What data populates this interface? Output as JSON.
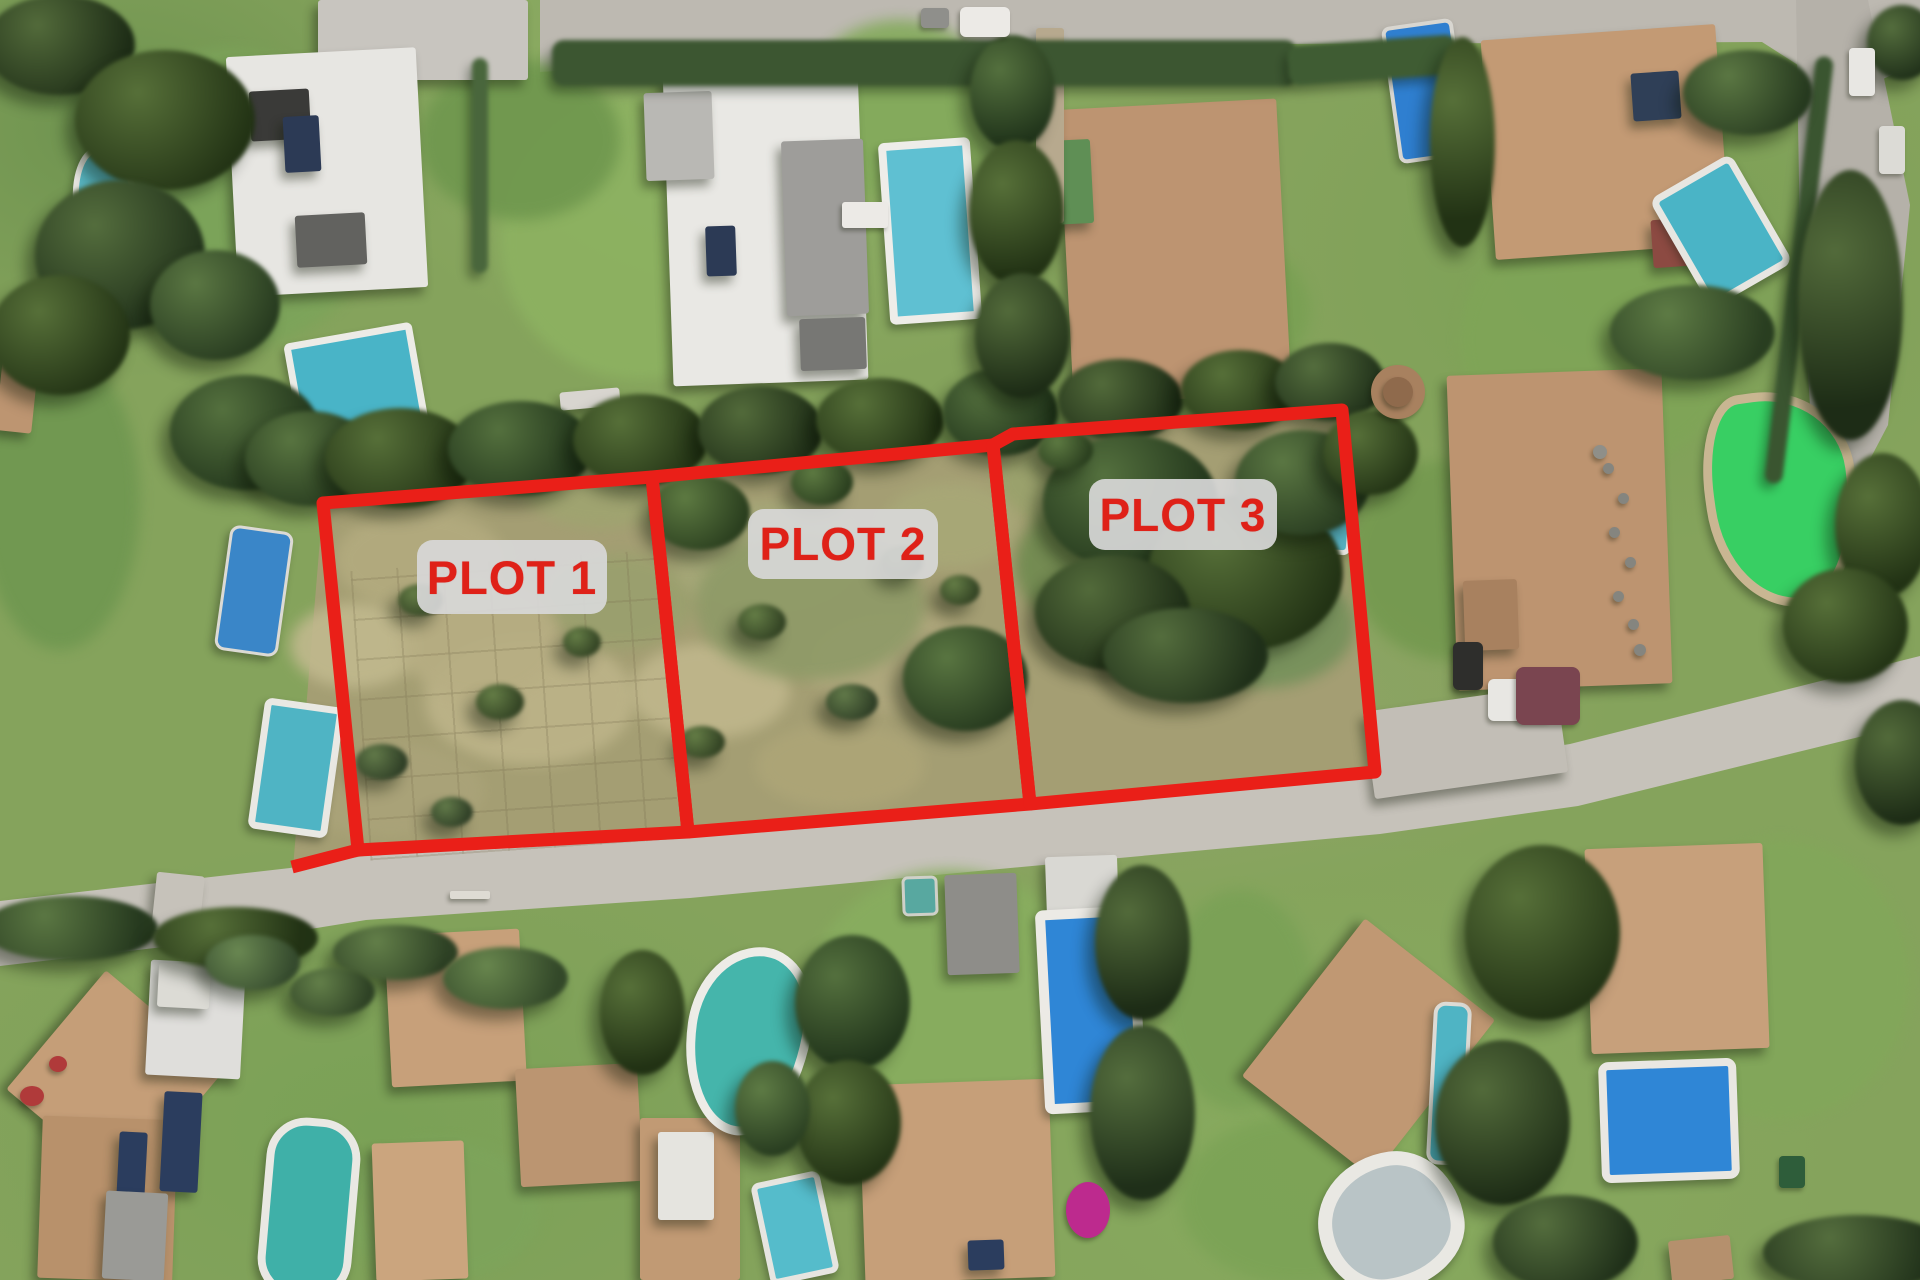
{
  "image": {
    "kind": "aerial-satellite-photo",
    "description": "Aerial view of a residential villa neighborhood with three vacant land parcels outlined in red"
  },
  "annotation": {
    "stroke_color": "#ea1f18",
    "stroke_width": 13,
    "label_bg": "rgba(216,216,216,0.92)",
    "label_text_color": "#df2118",
    "plots": [
      {
        "name": "plot-1",
        "label": "PLOT 1",
        "polygon": "323,503 652,477 688,832 358,850",
        "label_box": {
          "x": 417,
          "y": 540,
          "w": 190,
          "h": 74,
          "f": 47
        }
      },
      {
        "name": "plot-2",
        "label": "PLOT 2",
        "polygon": "652,477 993,445 1030,804 688,832",
        "label_box": {
          "x": 748,
          "y": 509,
          "w": 190,
          "h": 70,
          "f": 46
        }
      },
      {
        "name": "plot-3",
        "label": "PLOT 3",
        "polygon": "993,445 1013,434 1342,410 1375,772 1030,804",
        "label_box": {
          "x": 1089,
          "y": 479,
          "w": 188,
          "h": 71,
          "f": 46
        }
      }
    ],
    "extra_segments": [
      [
        358,
        850,
        292,
        867
      ]
    ]
  },
  "scene": {
    "polygons": [
      {
        "name": "plots-scrubland",
        "points": "323,503 652,477 993,445 1013,434 1342,410 1375,772 1030,804 688,832 362,858 293,868",
        "fill": "#a49e73"
      },
      {
        "name": "main-road",
        "points": "0,901 290,868 364,856 688,834 1030,807 1375,775 1570,744 1920,656 1920,722 1578,806 1380,834 1032,866 690,898 366,920 292,932 0,966",
        "fill": "#c6c2ba"
      },
      {
        "name": "top-road",
        "points": "540,0 1920,0 1920,62 1846,96 1762,42 1282,44 962,62 642,66 540,72",
        "fill": "#bdb9b1"
      },
      {
        "name": "right-road",
        "points": "1796,0 1868,0 1910,205 1888,425 1846,505 1814,472 1800,242",
        "fill": "#b5b1a9"
      }
    ],
    "grid": {
      "x": 360,
      "y": 560,
      "w": 310,
      "h": 290,
      "r": -4
    },
    "patches": [
      [
        230,
        200,
        300,
        300,
        "#7ca45a"
      ],
      [
        640,
        240,
        280,
        280,
        "#8db261"
      ],
      [
        900,
        110,
        200,
        180,
        "#84aa5c"
      ],
      [
        1200,
        310,
        220,
        160,
        "#79a053"
      ],
      [
        1600,
        340,
        280,
        260,
        "#7fa557"
      ],
      [
        1780,
        980,
        260,
        280,
        "#82a75a"
      ],
      [
        950,
        990,
        280,
        240,
        "#88ad5f"
      ],
      [
        1300,
        1200,
        240,
        170,
        "#7ca356"
      ],
      [
        520,
        140,
        200,
        160,
        "#6f974e"
      ],
      [
        1450,
        560,
        200,
        200,
        "#74994f"
      ],
      [
        60,
        500,
        160,
        300,
        "#6f9750"
      ],
      [
        440,
        1210,
        200,
        140,
        "#7da45b"
      ],
      [
        1240,
        1000,
        150,
        220,
        "#7aa156"
      ],
      [
        420,
        560,
        170,
        100,
        "#b3ab7f"
      ],
      [
        530,
        700,
        210,
        130,
        "#bdb489"
      ],
      [
        390,
        790,
        190,
        95,
        "#aaa379"
      ],
      [
        620,
        600,
        150,
        95,
        "#9aa06e"
      ],
      [
        770,
        560,
        190,
        115,
        "#a5a878"
      ],
      [
        890,
        660,
        170,
        105,
        "#b0a87d"
      ],
      [
        710,
        690,
        160,
        95,
        "#c0b78c"
      ],
      [
        1070,
        480,
        150,
        95,
        "#9aa26c"
      ],
      [
        950,
        525,
        135,
        85,
        "#a8a877"
      ],
      [
        600,
        485,
        155,
        85,
        "#9fa470"
      ],
      [
        355,
        645,
        130,
        85,
        "#c1b98e"
      ],
      [
        840,
        765,
        170,
        85,
        "#ada577"
      ],
      [
        1120,
        565,
        210,
        150,
        "#6f8a4f"
      ],
      [
        1260,
        625,
        190,
        125,
        "#74905a"
      ],
      [
        810,
        605,
        230,
        150,
        "#8e9a67"
      ],
      [
        480,
        640,
        160,
        120,
        "#b7ae83"
      ]
    ],
    "houses": [
      [
        318,
        0,
        210,
        80,
        0,
        "#c8c5bf",
        "h"
      ],
      [
        232,
        52,
        190,
        240,
        -3,
        "#e7e6e2"
      ],
      [
        250,
        90,
        60,
        50,
        -3,
        "#3a3a38"
      ],
      [
        284,
        116,
        36,
        56,
        -3,
        "#2c3a55"
      ],
      [
        296,
        214,
        70,
        52,
        -3,
        "#62625f"
      ],
      [
        668,
        68,
        195,
        315,
        -2,
        "#e9e8e4"
      ],
      [
        645,
        92,
        68,
        88,
        -2,
        "#b9b8b4",
        "h"
      ],
      [
        784,
        140,
        82,
        175,
        -2,
        "#9e9d9a"
      ],
      [
        706,
        226,
        30,
        50,
        -2,
        "#2c3a55"
      ],
      [
        800,
        318,
        66,
        52,
        -2,
        "#777774"
      ],
      [
        1066,
        104,
        218,
        295,
        -3,
        "#bd9471"
      ],
      [
        1048,
        140,
        44,
        84,
        -3,
        "#5f8f55"
      ],
      [
        1036,
        28,
        28,
        195,
        0,
        "#b7a98e"
      ],
      [
        1488,
        32,
        235,
        220,
        -4,
        "#c39a74"
      ],
      [
        1632,
        72,
        48,
        48,
        -4,
        "#2f3f57"
      ],
      [
        1652,
        218,
        64,
        48,
        -4,
        "#8c4a42"
      ],
      [
        1452,
        372,
        215,
        315,
        -2,
        "#bd9470"
      ],
      [
        1464,
        580,
        54,
        70,
        -2,
        "#a8815f"
      ],
      [
        1368,
        698,
        195,
        88,
        -8,
        "#c2beb6"
      ],
      [
        154,
        874,
        48,
        58,
        6,
        "#c6c2ba"
      ],
      [
        38,
        1002,
        155,
        155,
        40,
        "#c59e78"
      ],
      [
        40,
        1118,
        135,
        162,
        2,
        "#b8916b"
      ],
      [
        148,
        962,
        95,
        115,
        3,
        "#dfdedb"
      ],
      [
        162,
        1092,
        38,
        100,
        3,
        "#2b3d5e"
      ],
      [
        118,
        1132,
        28,
        68,
        3,
        "#2b3d5e"
      ],
      [
        104,
        1192,
        62,
        88,
        3,
        "#9a9a96"
      ],
      [
        158,
        964,
        52,
        44,
        3,
        "#dcdbd5"
      ],
      [
        388,
        932,
        135,
        152,
        -3,
        "#c7a07a"
      ],
      [
        374,
        1142,
        92,
        138,
        -2,
        "#cba57e"
      ],
      [
        518,
        1066,
        122,
        118,
        -3,
        "#bb9571"
      ],
      [
        640,
        1118,
        100,
        162,
        0,
        "#c19a74"
      ],
      [
        658,
        1132,
        56,
        88,
        0,
        "#e5e4df"
      ],
      [
        862,
        1082,
        190,
        198,
        -2,
        "#c69f79"
      ],
      [
        968,
        1240,
        36,
        30,
        -2,
        "#2b3d5e"
      ],
      [
        1286,
        948,
        165,
        200,
        38,
        "#c09873"
      ],
      [
        1588,
        846,
        178,
        205,
        -2,
        "#c7a07b"
      ],
      [
        1670,
        1238,
        62,
        44,
        -6,
        "#b5906d"
      ],
      [
        0,
        340,
        36,
        92,
        6,
        "#bd9571"
      ],
      [
        1046,
        856,
        72,
        62,
        -2,
        "#d9d8d3"
      ],
      [
        946,
        874,
        72,
        100,
        -2,
        "#8e8d89"
      ],
      [
        560,
        390,
        60,
        18,
        -5,
        "#d8d5cf"
      ]
    ],
    "pools": [
      [
        74,
        146,
        52,
        126,
        -4,
        "#5ab9c6",
        "#e9e8e3",
        6,
        "45% 55% 50% 50% / 40% 40% 62% 55%"
      ],
      [
        222,
        528,
        58,
        120,
        8,
        "#3a86c8",
        "#dcdad4",
        3,
        "10px"
      ],
      [
        256,
        702,
        66,
        118,
        8,
        "#4fb4c4",
        "#e9e8e3",
        7,
        "8px"
      ],
      [
        292,
        332,
        116,
        100,
        -10,
        "#49b4c7",
        "#ecebe6",
        7,
        "6px"
      ],
      [
        884,
        140,
        76,
        166,
        -4,
        "#5fc0d2",
        "#eeede9",
        8,
        "6px"
      ],
      [
        1390,
        22,
        64,
        130,
        -8,
        "#2f7fd0",
        "#d8d6d0",
        4,
        "8px"
      ],
      [
        1674,
        168,
        80,
        112,
        -30,
        "#4ab4c6",
        "#e7e6e1",
        7,
        "10px"
      ],
      [
        1706,
        390,
        134,
        200,
        -8,
        "#38cf63",
        "#c9b692",
        9,
        "30% 60% 45% 55% / 45% 40% 60% 50%"
      ],
      [
        1310,
        466,
        34,
        78,
        5,
        "#57b0c0",
        "#e4e3de",
        5,
        "8px"
      ],
      [
        686,
        946,
        106,
        172,
        8,
        "#45b5ab",
        "#edece7",
        9,
        "55% 45% 50% 50% / 45% 38% 62% 55%"
      ],
      [
        760,
        1176,
        58,
        92,
        -12,
        "#55bccb",
        "#e6e5e0",
        6,
        "8px"
      ],
      [
        1040,
        908,
        82,
        184,
        -3,
        "#2f86d6",
        "#eceae5",
        10,
        "8px"
      ],
      [
        262,
        1118,
        78,
        165,
        5,
        "#3fb0a8",
        "#e9e8e3",
        8,
        "40px"
      ],
      [
        1430,
        1002,
        30,
        155,
        3,
        "#4fb4c4",
        "#dddbd5",
        4,
        "12px"
      ],
      [
        1318,
        1152,
        118,
        112,
        -8,
        "#b9c4c6",
        "#e9e8e3",
        14,
        "55% 45% 58% 42% / 50% 55% 45% 50%"
      ],
      [
        1600,
        1060,
        122,
        105,
        -2,
        "#2f86d6",
        "#e9e7e2",
        8,
        "10px"
      ],
      [
        902,
        876,
        30,
        34,
        -2,
        "#58a8a0",
        "#cfd0c8",
        3,
        "6px"
      ]
    ],
    "hedges": [
      [
        552,
        40,
        745,
        46,
        0,
        "#3c5631"
      ],
      [
        472,
        58,
        16,
        215,
        0,
        "#49663c"
      ],
      [
        1790,
        55,
        18,
        430,
        7,
        "#3a5530"
      ],
      [
        1288,
        40,
        170,
        40,
        -4,
        "#3f5c33"
      ]
    ],
    "trees": [
      [
        60,
        45,
        150,
        100,
        "#2c4022"
      ],
      [
        165,
        120,
        180,
        140,
        "#33491f"
      ],
      [
        120,
        255,
        170,
        150,
        "#2f4527"
      ],
      [
        60,
        335,
        140,
        120,
        "#33491f"
      ],
      [
        215,
        305,
        130,
        110,
        "#3a5530"
      ],
      [
        245,
        432,
        150,
        115,
        "#2f4a28"
      ],
      [
        310,
        458,
        130,
        95,
        "#36512c"
      ],
      [
        400,
        458,
        150,
        100,
        "#33491f"
      ],
      [
        520,
        448,
        145,
        95,
        "#2f4a28"
      ],
      [
        640,
        440,
        135,
        92,
        "#33491f"
      ],
      [
        760,
        430,
        125,
        88,
        "#2c4022"
      ],
      [
        880,
        420,
        128,
        85,
        "#33491f"
      ],
      [
        1000,
        412,
        115,
        88,
        "#2f4a28"
      ],
      [
        1120,
        400,
        125,
        82,
        "#2c4022"
      ],
      [
        1240,
        390,
        118,
        80,
        "#33491f"
      ],
      [
        1330,
        382,
        110,
        78,
        "#2f4527"
      ],
      [
        1012,
        92,
        85,
        115,
        "#2f4a28"
      ],
      [
        1016,
        212,
        95,
        145,
        "#33491f"
      ],
      [
        1022,
        335,
        95,
        125,
        "#2c4022"
      ],
      [
        1130,
        502,
        175,
        135,
        "#2f4a28"
      ],
      [
        1245,
        572,
        195,
        155,
        "#33491f"
      ],
      [
        1112,
        612,
        155,
        115,
        "#2c4022"
      ],
      [
        1302,
        482,
        135,
        105,
        "#3a5530"
      ],
      [
        1185,
        655,
        165,
        95,
        "#2f4527"
      ],
      [
        965,
        678,
        125,
        105,
        "#37522d"
      ],
      [
        700,
        512,
        100,
        75,
        "#3e5a2e"
      ],
      [
        1370,
        452,
        95,
        85,
        "#33491f"
      ],
      [
        1850,
        305,
        105,
        270,
        "#2c4022"
      ],
      [
        1882,
        525,
        95,
        145,
        "#33491f"
      ],
      [
        1692,
        332,
        165,
        95,
        "#3f5c33"
      ],
      [
        1845,
        625,
        125,
        115,
        "#33491f"
      ],
      [
        70,
        928,
        175,
        65,
        "#3a5530"
      ],
      [
        235,
        938,
        165,
        62,
        "#33491f"
      ],
      [
        395,
        952,
        125,
        55,
        "#47623a"
      ],
      [
        505,
        978,
        125,
        62,
        "#4f6d41"
      ],
      [
        852,
        1002,
        115,
        135,
        "#2f4a28"
      ],
      [
        848,
        1122,
        105,
        125,
        "#33491f"
      ],
      [
        1142,
        942,
        95,
        155,
        "#2c4022"
      ],
      [
        1142,
        1112,
        105,
        175,
        "#2f4527"
      ],
      [
        1542,
        932,
        155,
        175,
        "#33491f"
      ],
      [
        1502,
        1122,
        135,
        165,
        "#2c4022"
      ],
      [
        1565,
        1242,
        145,
        95,
        "#2f4527"
      ],
      [
        772,
        1108,
        75,
        95,
        "#3f5c33"
      ],
      [
        642,
        1012,
        85,
        125,
        "#33491f"
      ],
      [
        252,
        962,
        95,
        55,
        "#527048"
      ],
      [
        332,
        992,
        85,
        48,
        "#47623a"
      ],
      [
        1462,
        142,
        65,
        210,
        "#33491f"
      ],
      [
        1748,
        92,
        130,
        85,
        "#3a5530"
      ],
      [
        1902,
        42,
        70,
        75,
        "#2f4527"
      ],
      [
        1902,
        762,
        95,
        125,
        "#2c4022"
      ],
      [
        1858,
        1252,
        190,
        75,
        "#2f4527"
      ],
      [
        420,
        600,
        45,
        32,
        "#4a5f35"
      ],
      [
        500,
        702,
        48,
        36,
        "#4a5f35"
      ],
      [
        382,
        762,
        52,
        36,
        "#45593a"
      ],
      [
        582,
        642,
        38,
        30,
        "#4a5f35"
      ],
      [
        452,
        812,
        42,
        30,
        "#45593a"
      ],
      [
        762,
        622,
        48,
        36,
        "#4a5f35"
      ],
      [
        852,
        702,
        52,
        36,
        "#45593a"
      ],
      [
        702,
        742,
        46,
        32,
        "#4a5f35"
      ],
      [
        902,
        562,
        42,
        32,
        "#4a5f35"
      ],
      [
        822,
        482,
        62,
        46,
        "#3e5a2e"
      ],
      [
        960,
        590,
        40,
        30,
        "#4a5f35"
      ],
      [
        1065,
        450,
        55,
        40,
        "#3e5a2e"
      ]
    ],
    "spots": [
      [
        985,
        22,
        50,
        30,
        "#eceae6",
        "6px"
      ],
      [
        935,
        18,
        28,
        20,
        "#8f8f8b",
        "4px"
      ],
      [
        1862,
        72,
        26,
        48,
        "#e8e7e3",
        "4px"
      ],
      [
        1892,
        150,
        26,
        48,
        "#dcdbd6",
        "4px"
      ],
      [
        1468,
        666,
        30,
        48,
        "#2e2e2c",
        "6px"
      ],
      [
        1520,
        700,
        64,
        42,
        "#e8e7e3",
        "6px"
      ],
      [
        1548,
        696,
        64,
        58,
        "#7a4550",
        "8px"
      ],
      [
        1088,
        1210,
        44,
        56,
        "#bd2a8e",
        "50%"
      ],
      [
        32,
        1096,
        24,
        20,
        "#b03a3a",
        "50%"
      ],
      [
        58,
        1064,
        18,
        16,
        "#b03a3a",
        "50%"
      ],
      [
        1398,
        392,
        54,
        54,
        "#a8815f",
        "50%"
      ],
      [
        1398,
        392,
        30,
        30,
        "#8f6a4c",
        "50%"
      ],
      [
        1600,
        452,
        14,
        14,
        "#8f8f89",
        "50%"
      ],
      [
        1608,
        468,
        11,
        11,
        "#85857f",
        "50%"
      ],
      [
        1623,
        498,
        11,
        11,
        "#85857f",
        "50%"
      ],
      [
        1614,
        532,
        11,
        11,
        "#85857f",
        "50%"
      ],
      [
        1630,
        562,
        11,
        11,
        "#85857f",
        "50%"
      ],
      [
        1618,
        596,
        11,
        11,
        "#85857f",
        "50%"
      ],
      [
        1633,
        624,
        11,
        11,
        "#85857f",
        "50%"
      ],
      [
        1640,
        650,
        12,
        12,
        "#85857f",
        "50%"
      ],
      [
        1792,
        1172,
        26,
        32,
        "#2e5d3a",
        "4px"
      ],
      [
        865,
        215,
        46,
        26,
        "#eceae6",
        "3px"
      ],
      [
        470,
        895,
        40,
        8,
        "#dedbd3",
        "2px"
      ]
    ]
  }
}
